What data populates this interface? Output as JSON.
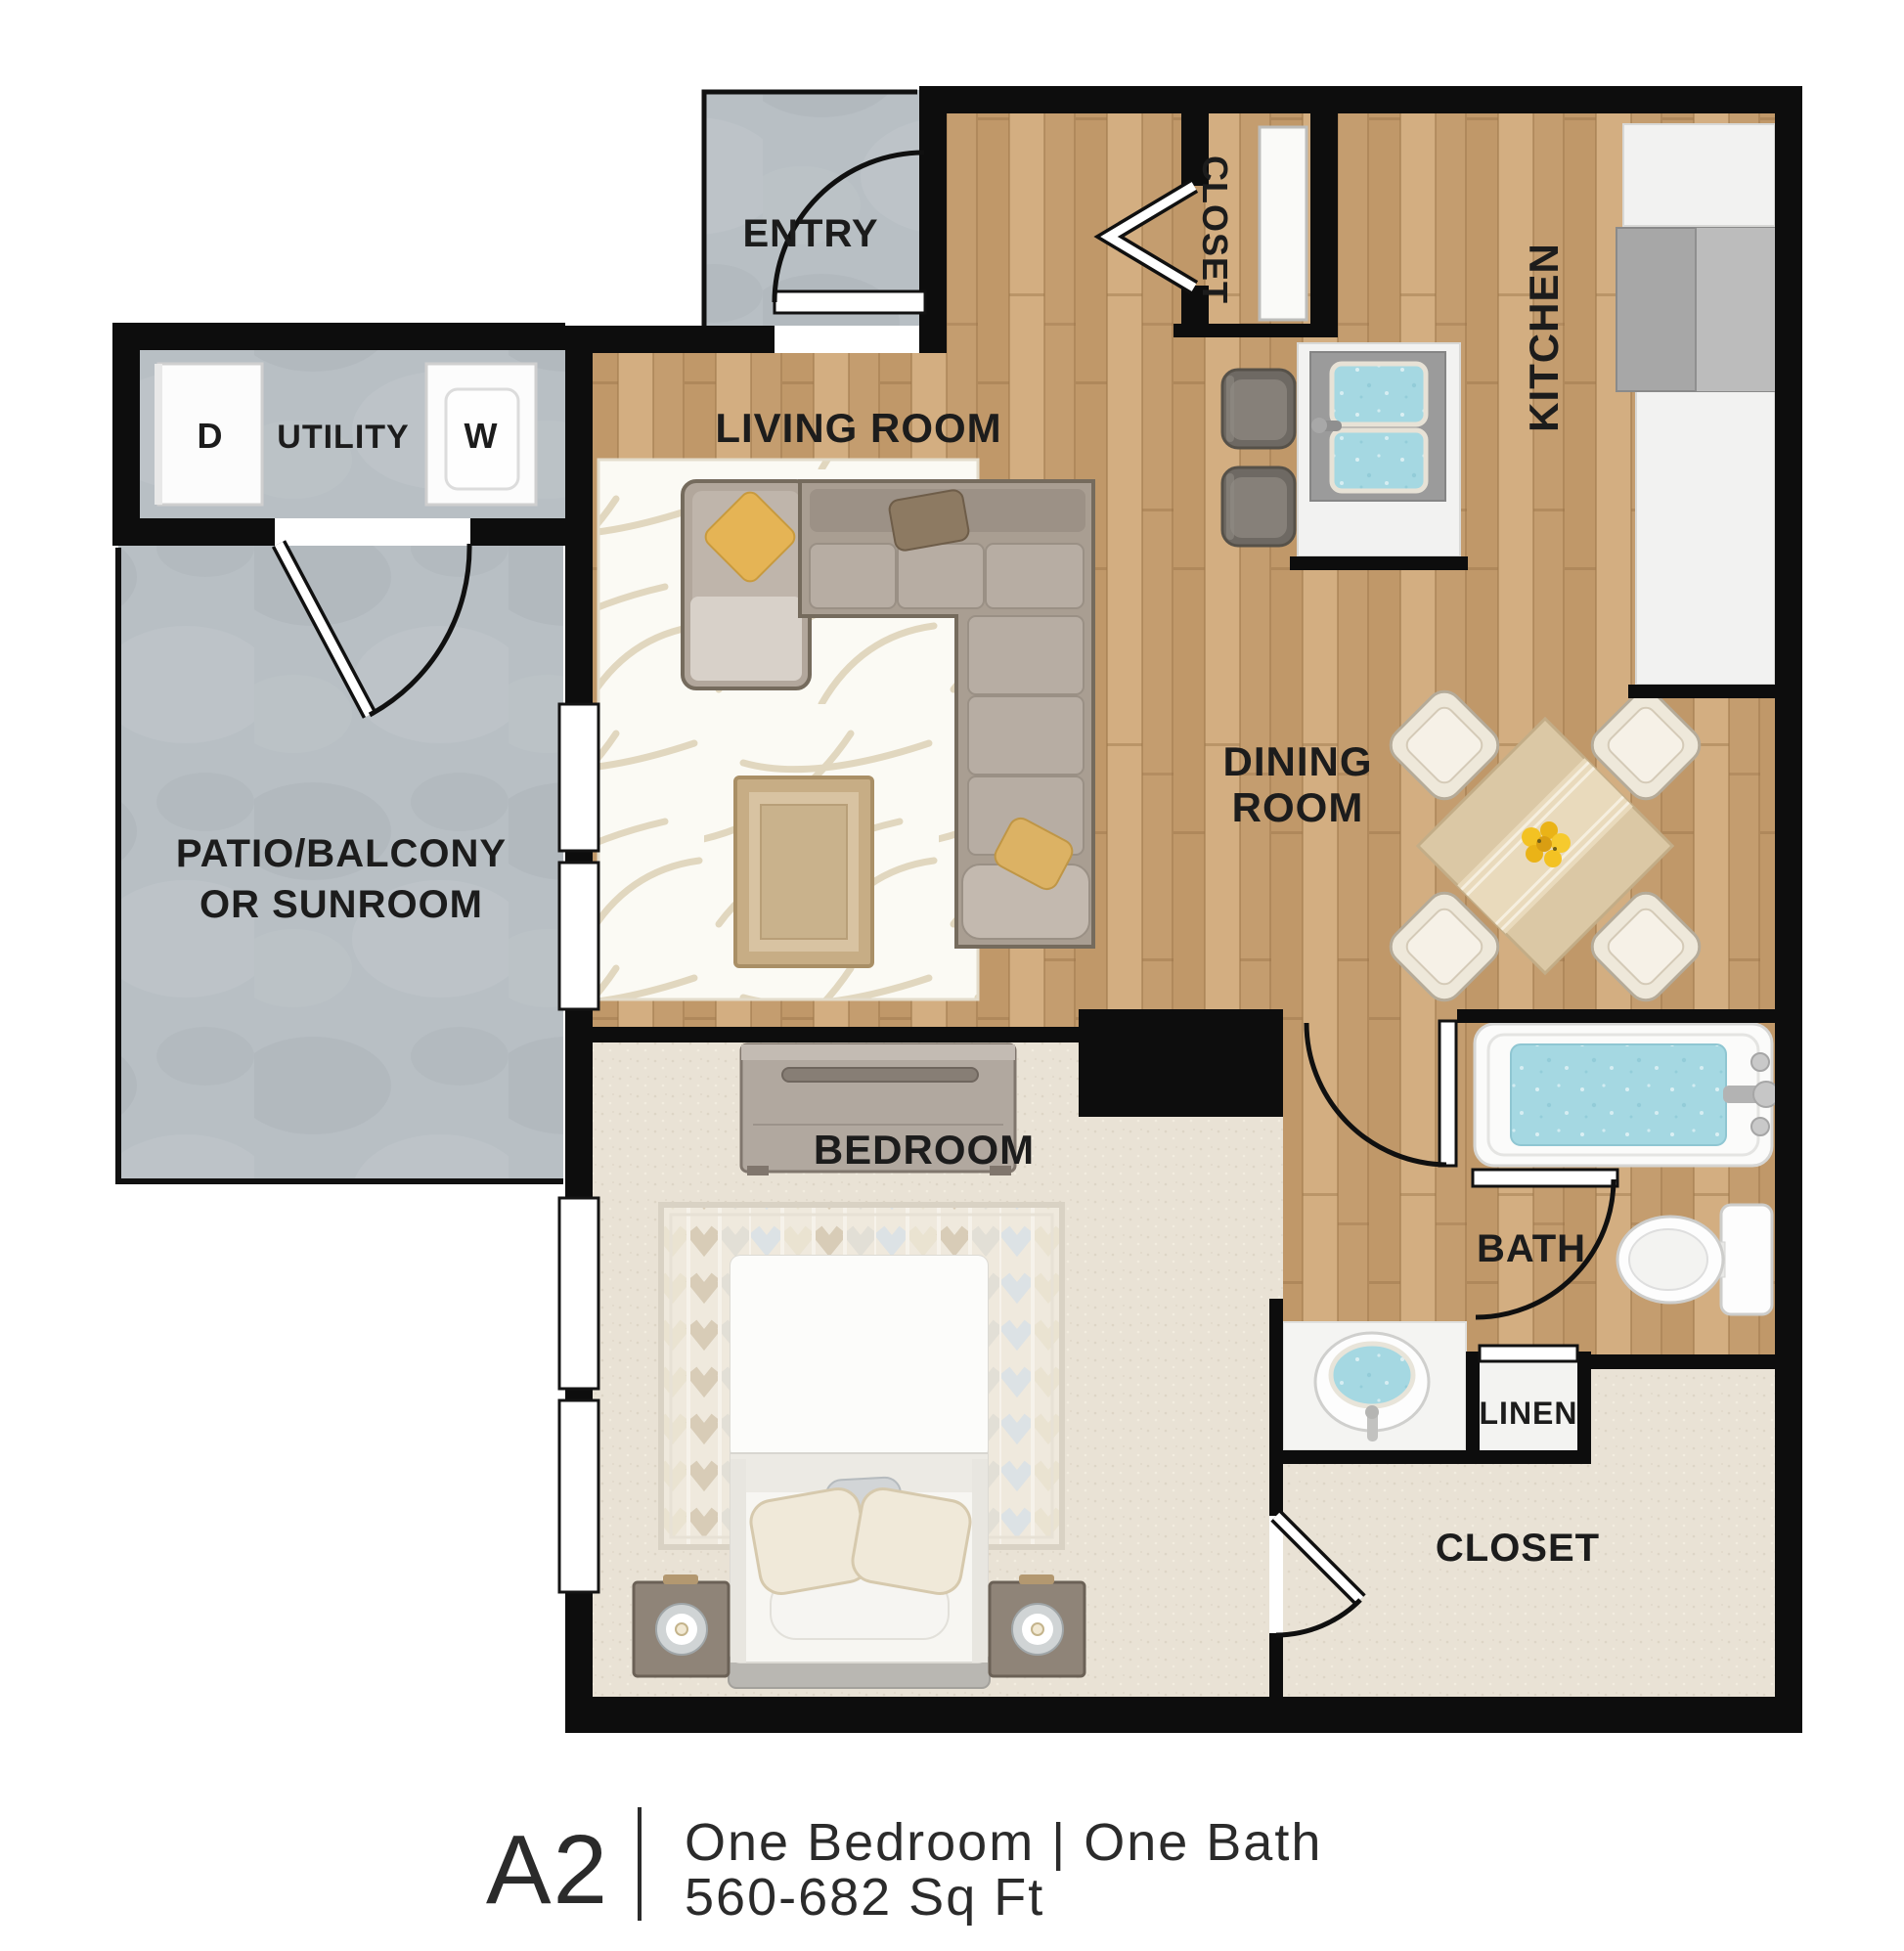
{
  "plan": {
    "unit_code": "A2",
    "caption": {
      "code": "A2",
      "line1": "One Bedroom | One Bath",
      "line2": "560-682 Sq Ft"
    },
    "labels": {
      "entry": "ENTRY",
      "closet_top": "CLOSET",
      "kitchen": "KITCHEN",
      "utility": "UTILITY",
      "dryer": "D",
      "washer": "W",
      "living": "LIVING ROOM",
      "dining": [
        "DINING",
        "ROOM"
      ],
      "patio": [
        "PATIO/BALCONY",
        "OR SUNROOM"
      ],
      "bedroom": "BEDROOM",
      "bath": "BATH",
      "linen": "LINEN",
      "closet_main": "CLOSET"
    },
    "colors": {
      "wall": "#0d0d0d",
      "wood_floor": "#c9a377",
      "carpet": "#e9e2d5",
      "concrete": "#b8bfc4",
      "water": "#a5d8e2",
      "accent_yellow": "#e5b455",
      "label_text": "#1c1c1c"
    }
  }
}
